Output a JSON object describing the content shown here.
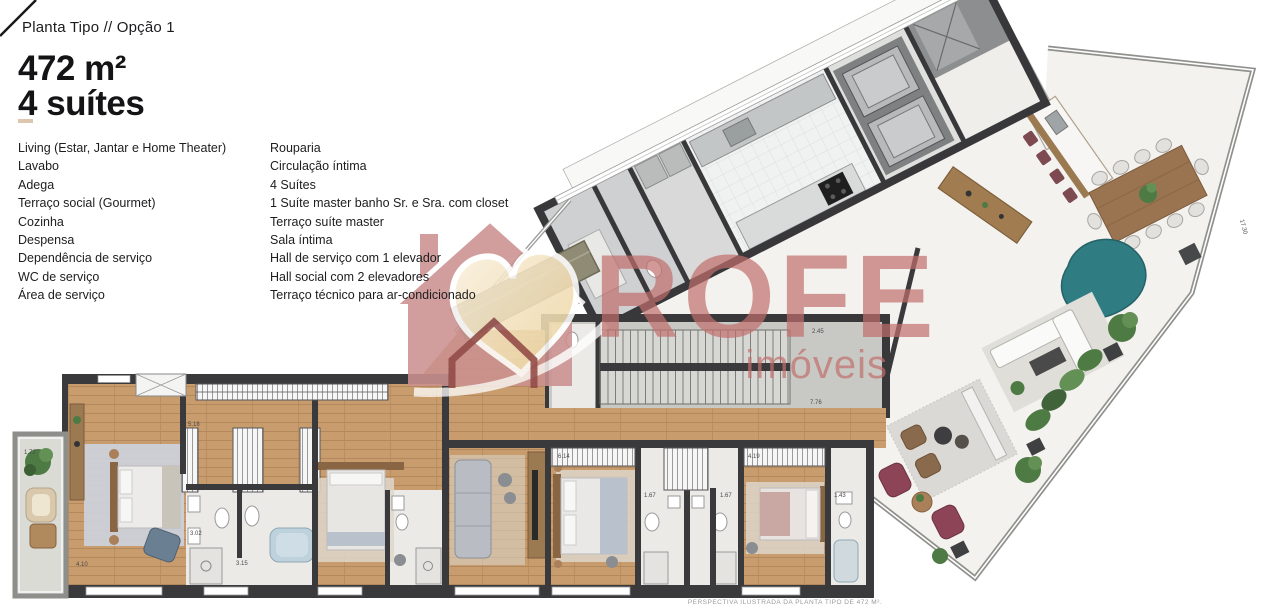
{
  "header": {
    "breadcrumb": "Planta Tipo  //  Opção 1",
    "area": "472 m²",
    "suites": "4 suítes"
  },
  "program": {
    "left": [
      "Living (Estar, Jantar e Home Theater)",
      "Lavabo",
      "Adega",
      "Terraço social (Gourmet)",
      "Cozinha",
      "Despensa",
      "Dependência de serviço",
      "WC de serviço",
      "Área de serviço"
    ],
    "right": [
      "Rouparia",
      "Circulação íntima",
      "4 Suítes",
      "1 Suíte master banho Sr. e Sra. com closet",
      "Terraço suíte master",
      "Sala íntima",
      "Hall de serviço com 1 elevador",
      "Hall social com 2 elevadores",
      "Terraço técnico para ar-condicionado"
    ]
  },
  "watermark": {
    "brand": "ROFE",
    "tagline": "imóveis",
    "rose": "#cb9190",
    "cream": "#f0ddb0",
    "text_color": "#c2706d"
  },
  "plan": {
    "caption": "PERSPECTIVA ILUSTRADA DA PLANTA TIPO DE 472 M².",
    "dimensions": [
      "1.72",
      "4.10",
      "3.02",
      "3.15",
      "5.18",
      "6.14",
      "4.19",
      "1.67",
      "1.67",
      "1.43",
      "7.76",
      "2.45",
      "17.30"
    ],
    "palette": {
      "wall": "#3a3a3c",
      "wood_floor": "#c99c6d",
      "marble": "#f4f2ef",
      "bath": "#eceae7",
      "terrace_master": "#dadbd5",
      "teal_sofa": "#2f7c82",
      "plant": "#4e7a44",
      "maroon": "#8e4457"
    }
  }
}
